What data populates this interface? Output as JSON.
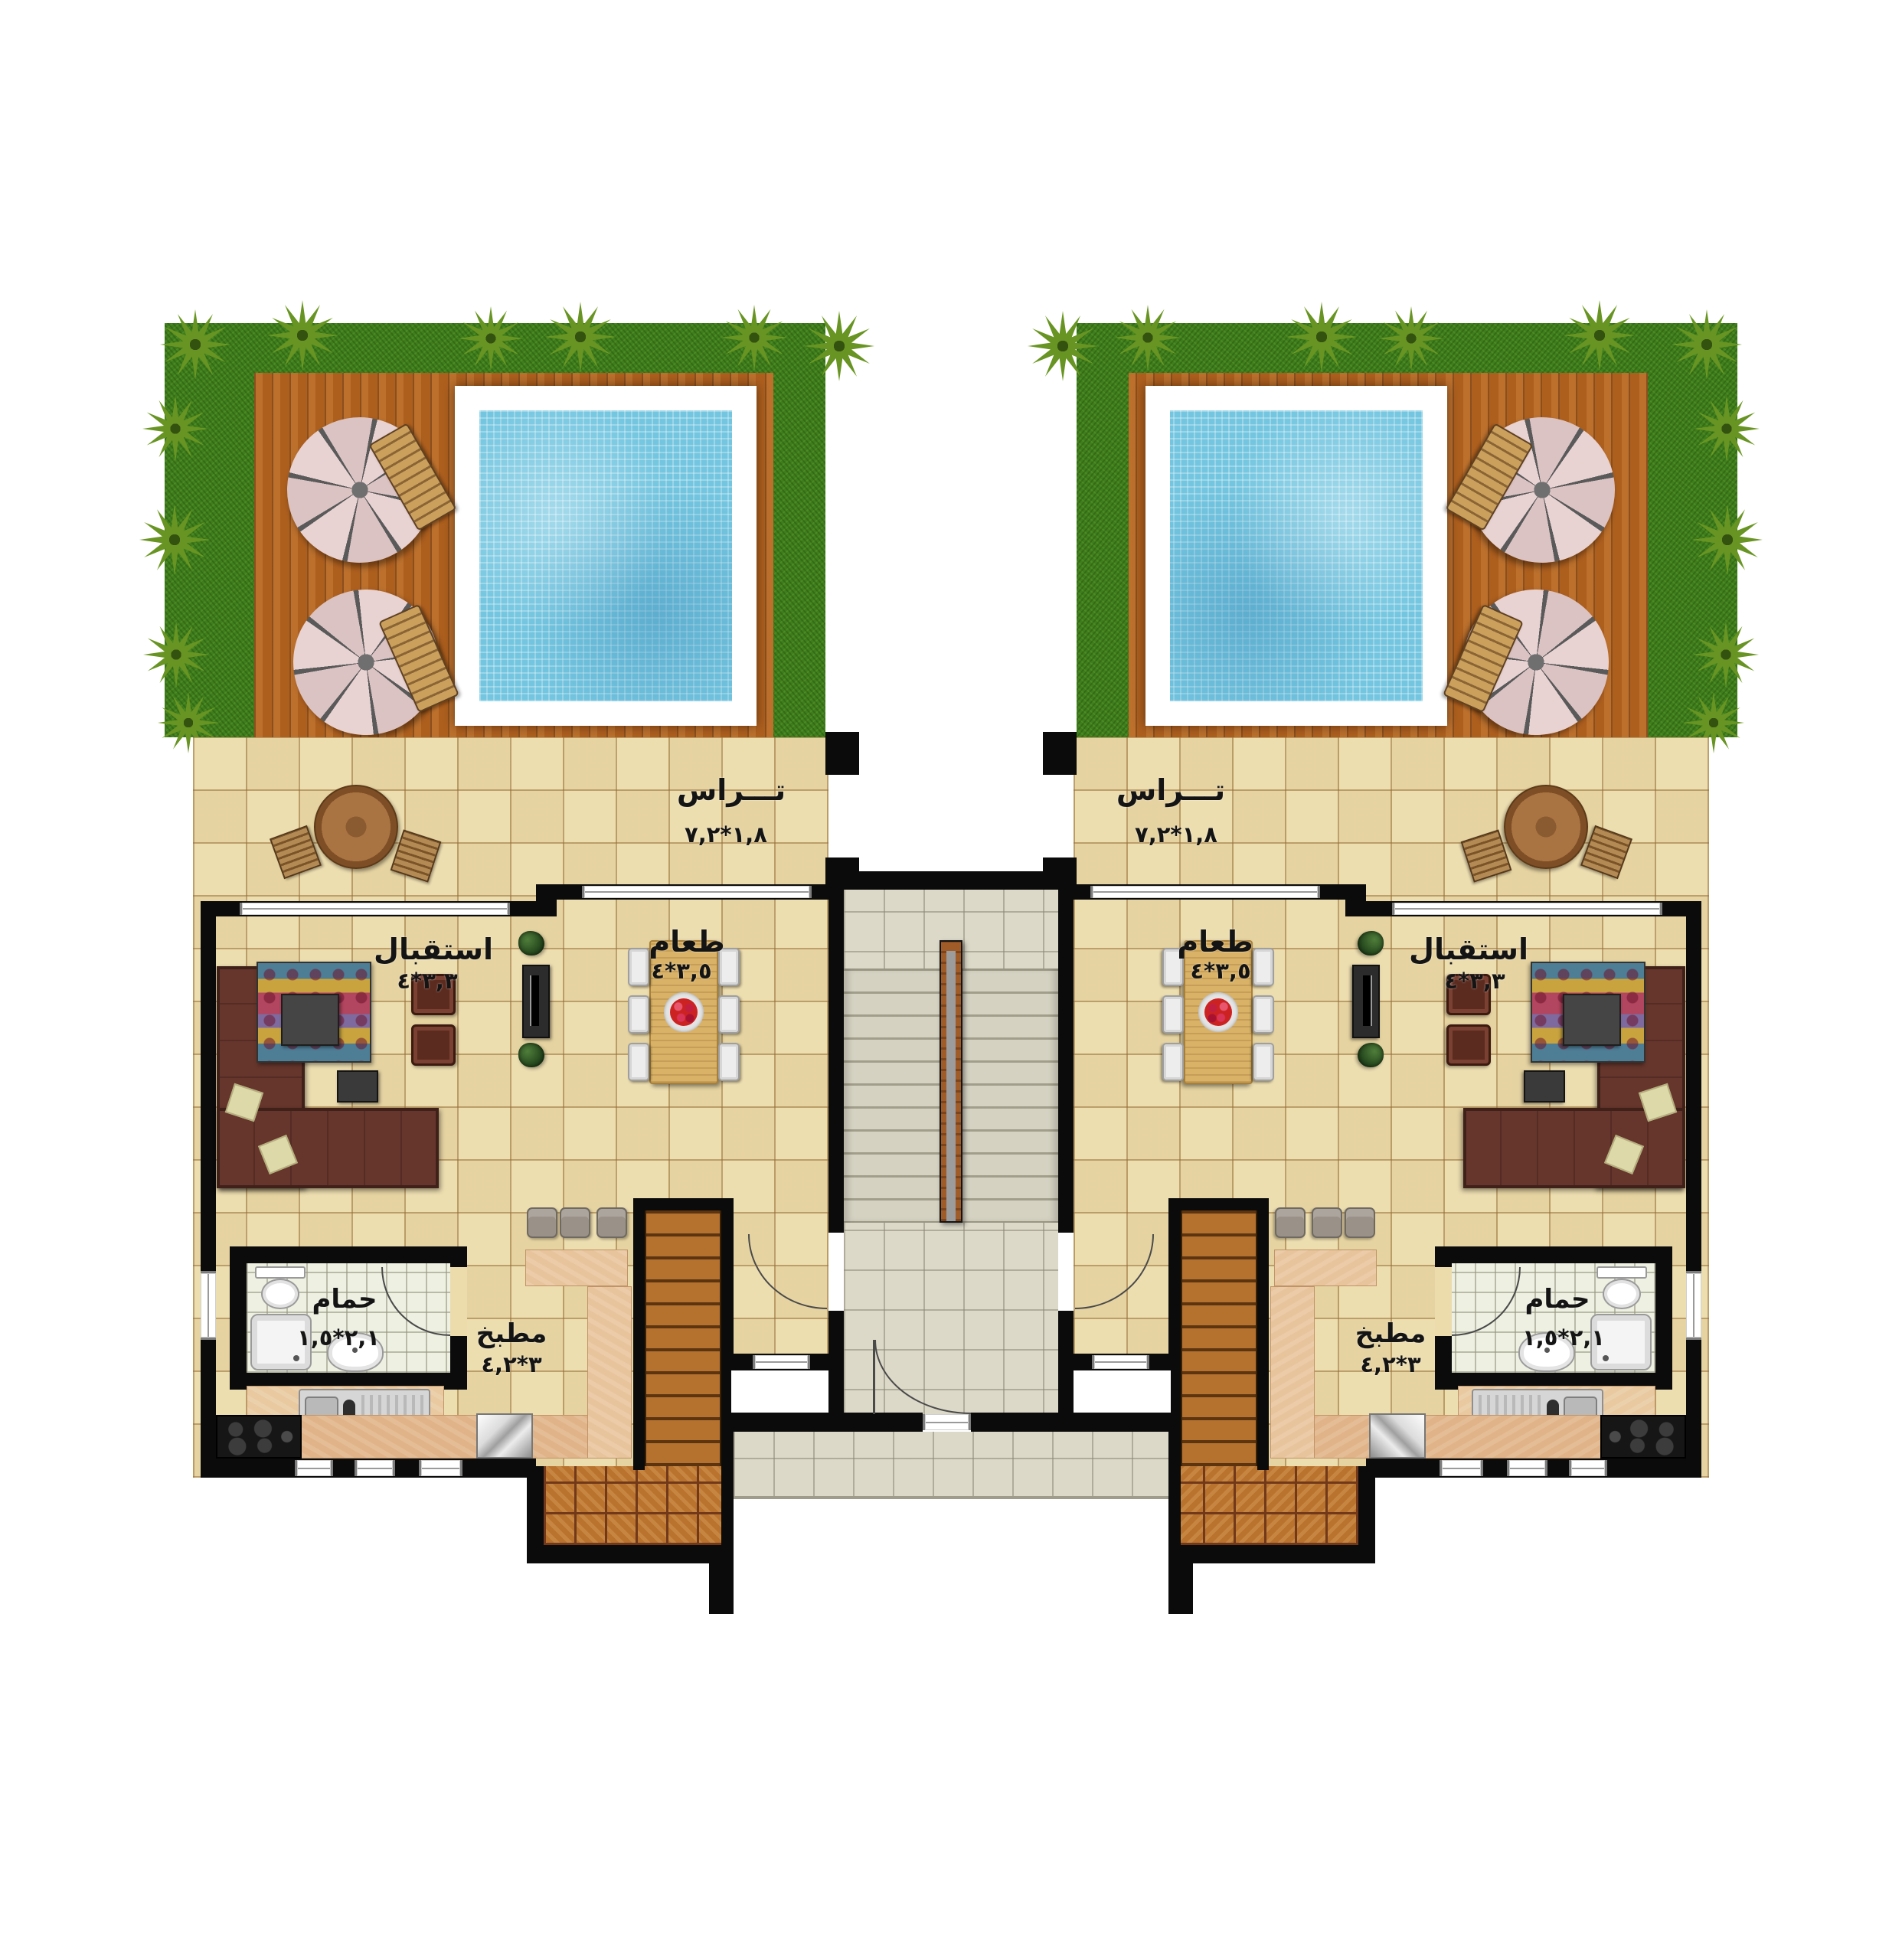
{
  "document": {
    "type": "residential-floor-plan",
    "description": "Two mirrored twin apartment units with private gardens, pools and a shared central staircase",
    "units_count": 2
  },
  "unit_left": {
    "terrace": {
      "name": "تـــراس",
      "dims": "١,٨*٧,٢"
    },
    "reception": {
      "name": "استقبال",
      "dims": "٣,٣*٤"
    },
    "dining": {
      "name": "طعام",
      "dims": "٣,٥*٤"
    },
    "bathroom": {
      "name": "حمام",
      "dims": "٢,١*١,٥"
    },
    "kitchen": {
      "name": "مطبخ",
      "dims": "٣*٤,٢"
    }
  },
  "unit_right": {
    "terrace": {
      "name": "تـــراس",
      "dims": "١,٨*٧,٢"
    },
    "reception": {
      "name": "استقبال",
      "dims": "٣,٣*٤"
    },
    "dining": {
      "name": "طعام",
      "dims": "٣,٥*٤"
    },
    "bathroom": {
      "name": "حمام",
      "dims": "٢,١*١,٥"
    },
    "kitchen": {
      "name": "مطبخ",
      "dims": "٣*٤,٢"
    }
  },
  "legend_colors": {
    "grass": "#3f7d1d",
    "deck_wood": "#ad5f1e",
    "pool_water": "#74c6e0",
    "floor_tile": "#ecdcab",
    "hall_tile": "#dcd9c9",
    "parquet": "#b9732e",
    "wall": "#0b0b0b"
  }
}
